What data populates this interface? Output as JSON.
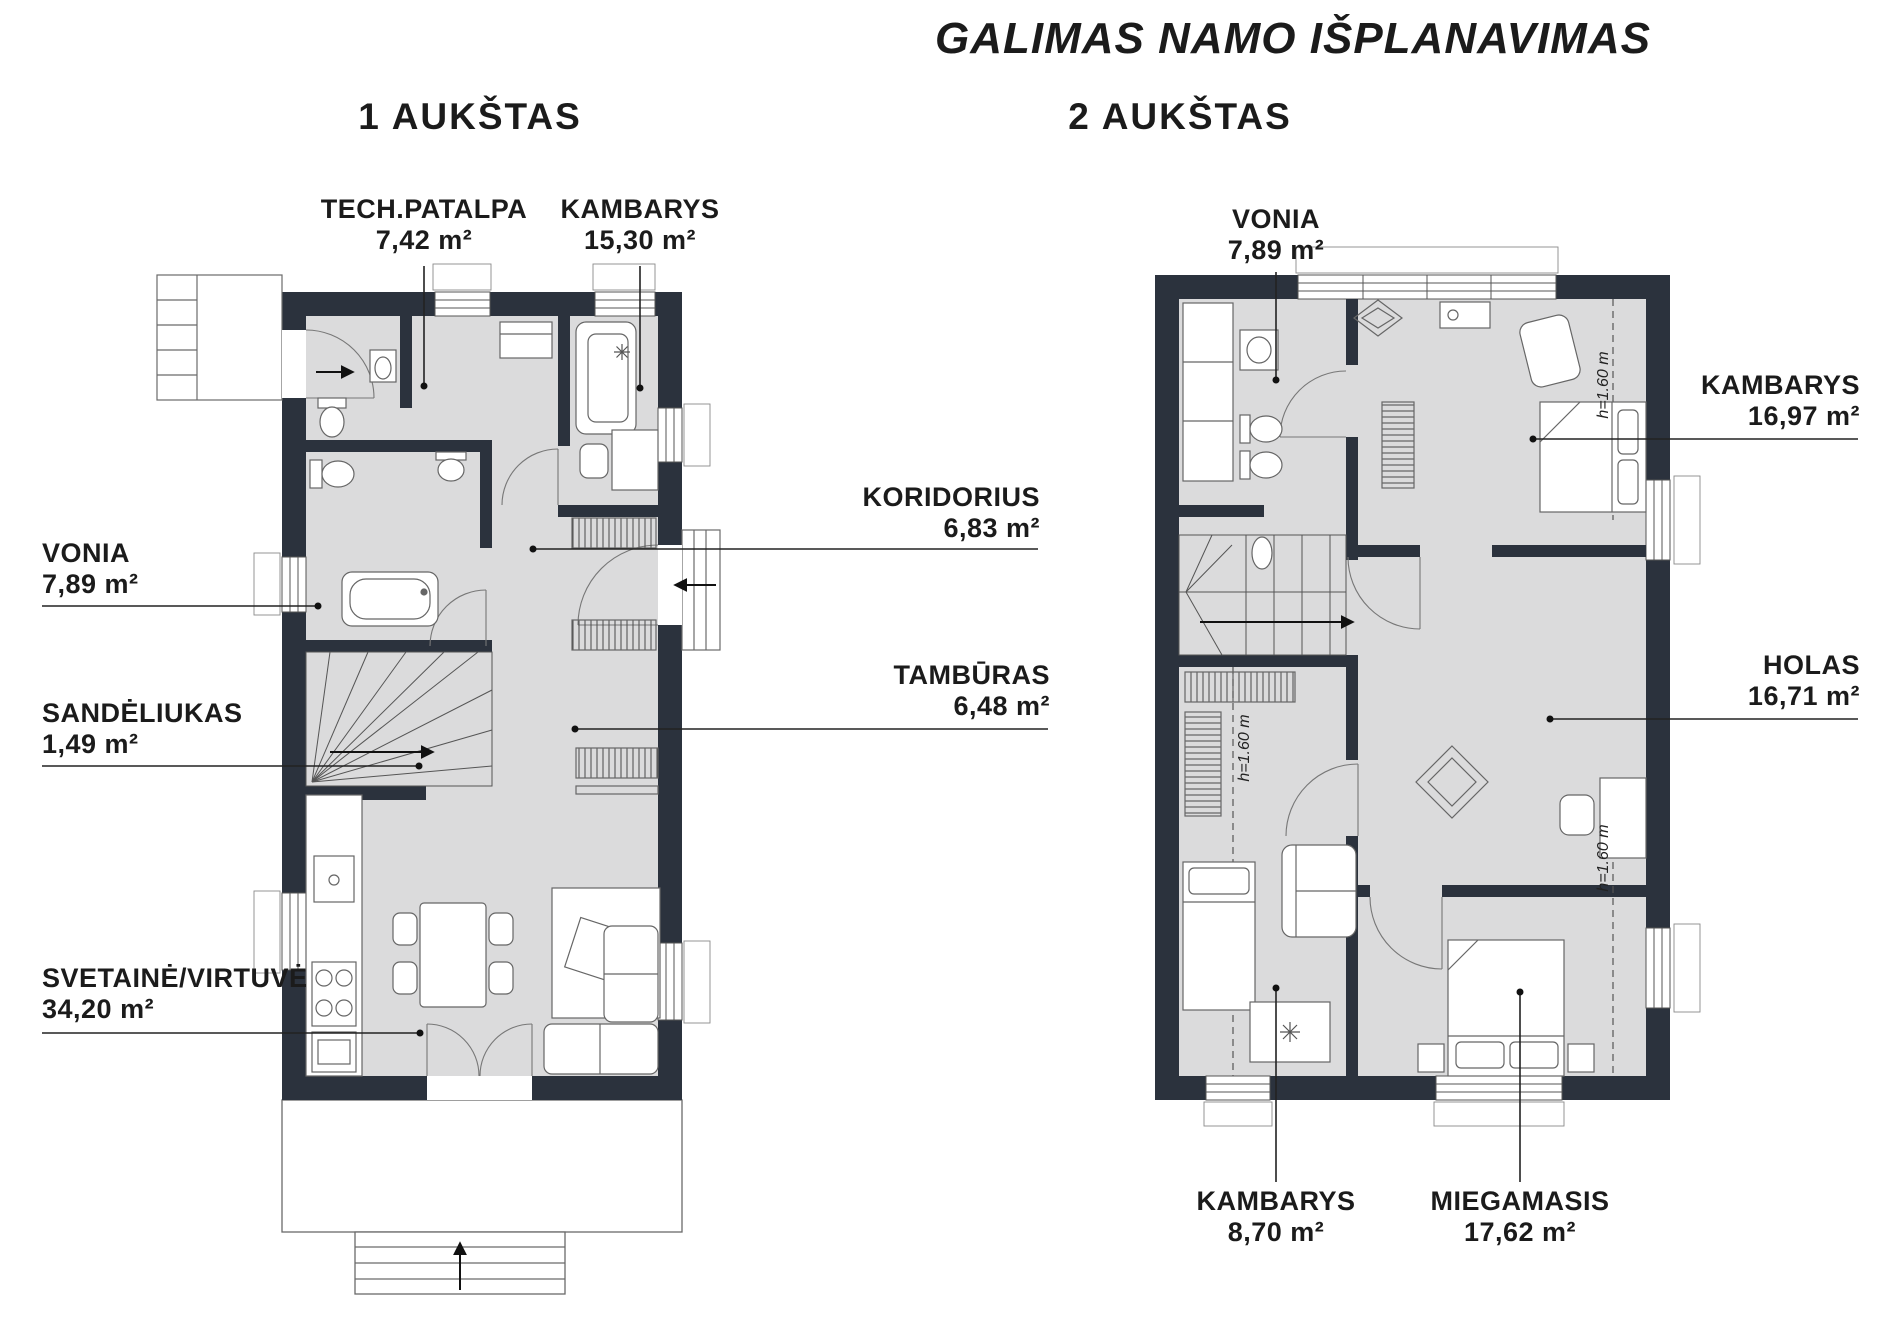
{
  "title": "GALIMAS NAMO IŠPLANAVIMAS",
  "floor1": {
    "title": "1 AUKŠTAS",
    "rooms": [
      {
        "name": "TECH.PATALPA",
        "area": "7,42 m²"
      },
      {
        "name": "KAMBARYS",
        "area": "15,30 m²"
      },
      {
        "name": "KORIDORIUS",
        "area": "6,83 m²"
      },
      {
        "name": "VONIA",
        "area": "7,89 m²"
      },
      {
        "name": "TAMBŪRAS",
        "area": "6,48 m²"
      },
      {
        "name": "SANDĖLIUKAS",
        "area": "1,49 m²"
      },
      {
        "name": "SVETAINĖ/VIRTUVĖ",
        "area": "34,20 m²"
      }
    ]
  },
  "floor2": {
    "title": "2 AUKŠTAS",
    "height_annotation": "h=1.60 m",
    "rooms": [
      {
        "name": "VONIA",
        "area": "7,89 m²"
      },
      {
        "name": "KAMBARYS",
        "area": "16,97 m²"
      },
      {
        "name": "HOLAS",
        "area": "16,71 m²"
      },
      {
        "name": "KAMBARYS",
        "area": "8,70 m²"
      },
      {
        "name": "MIEGAMASIS",
        "area": "17,62 m²"
      }
    ]
  },
  "colors": {
    "wall": "#2b323d",
    "floor": "#dbdbdc",
    "leader": "#222222"
  }
}
